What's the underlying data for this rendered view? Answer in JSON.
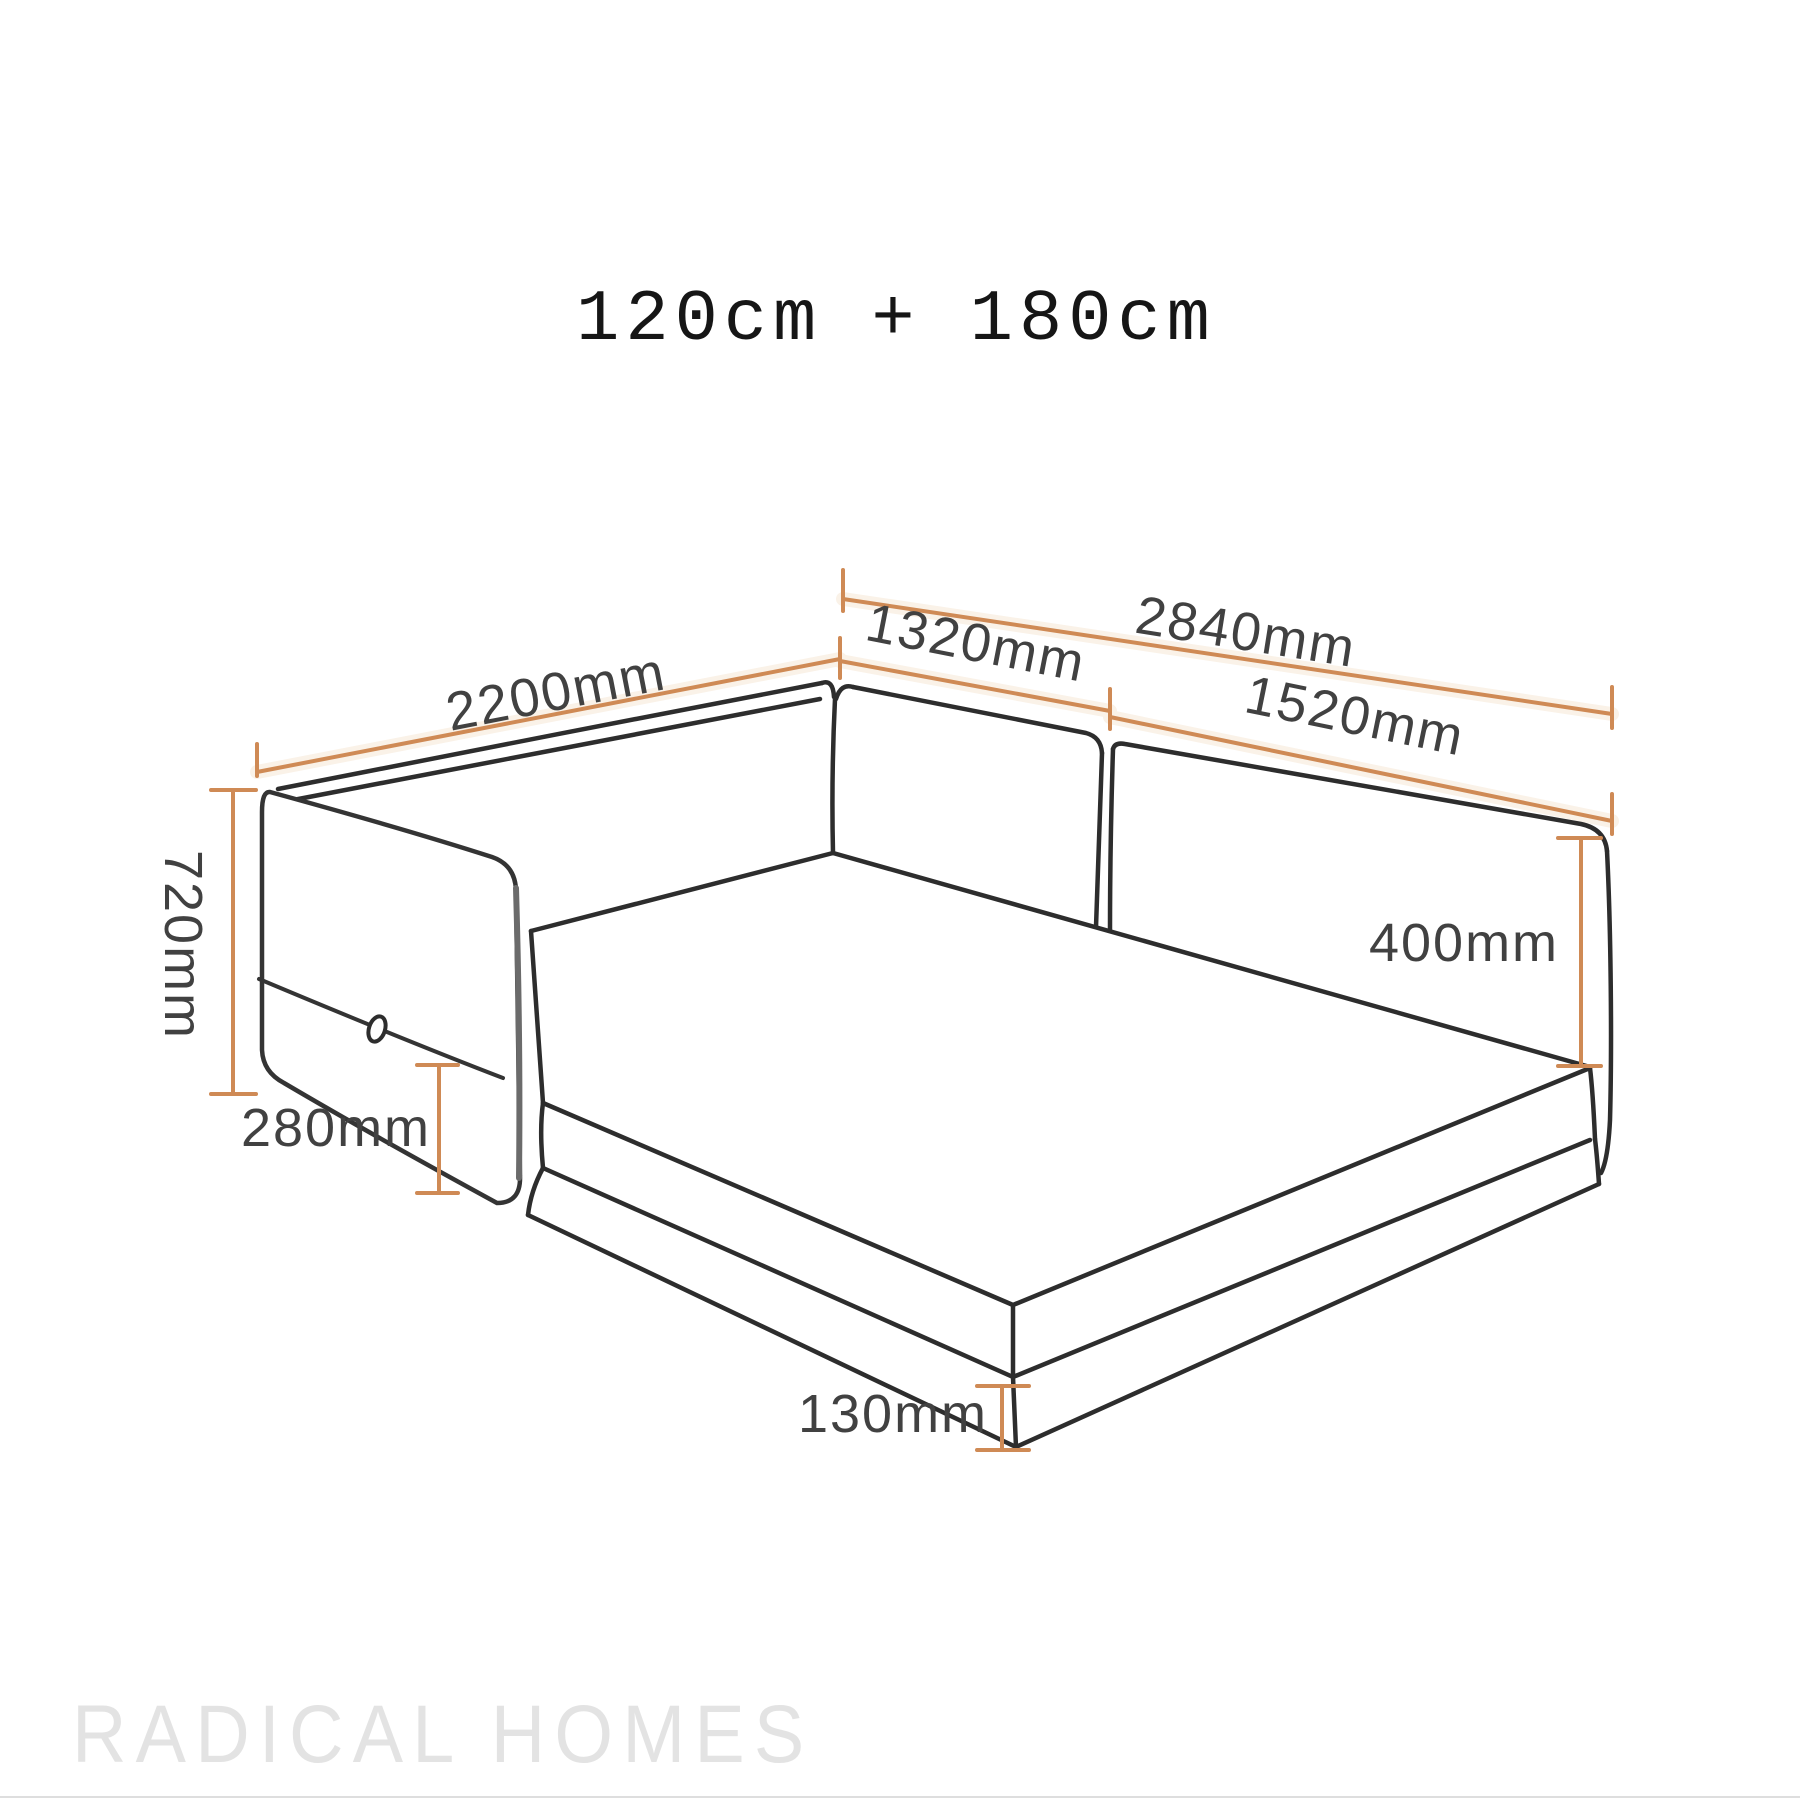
{
  "title": "120cm + 180cm",
  "watermark": "RADICAL HOMES",
  "colors": {
    "dimension_line": "#cf8a55",
    "outline": "#2d2d2d",
    "label_text": "#414141",
    "watermark_text": "#e3e3e3"
  },
  "diagram": {
    "type": "furniture-dimension-diagram",
    "subject": "corner sofa bed, two sections (120cm + 180cm)",
    "dims": {
      "d2840": "2840mm",
      "d2200": "2200mm",
      "d1320": "1320mm",
      "d1520": "1520mm",
      "d720": "720mm",
      "d280": "280mm",
      "d400": "400mm",
      "d130": "130mm"
    }
  }
}
